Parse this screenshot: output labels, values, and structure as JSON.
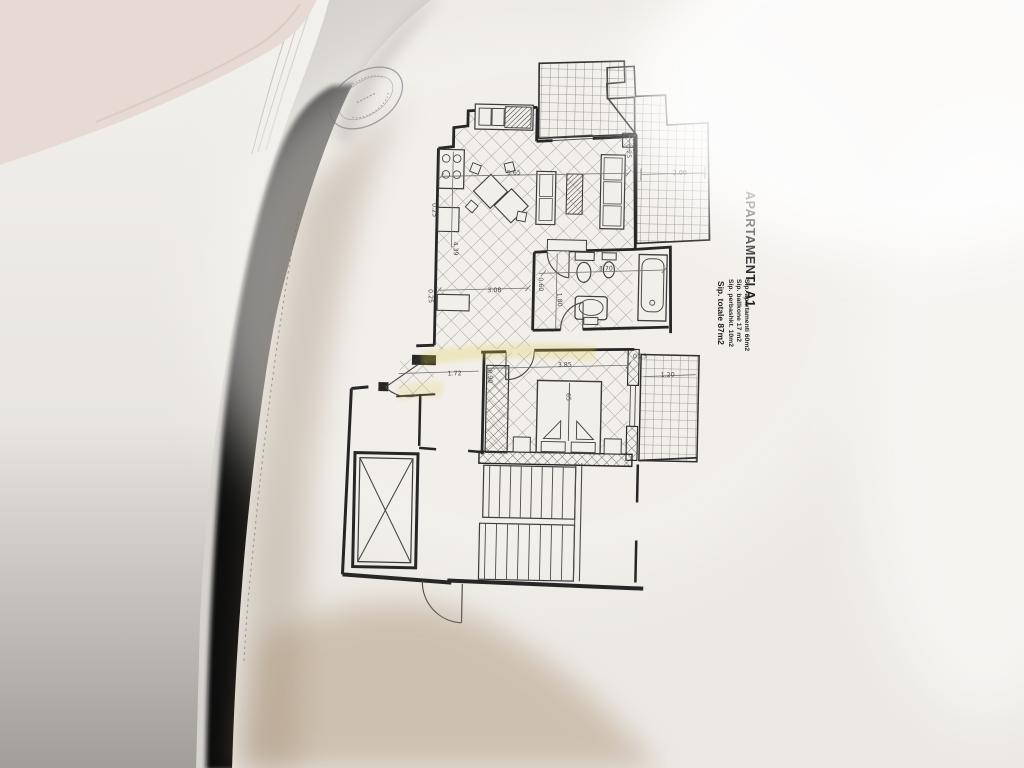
{
  "annotations": {
    "title": "APARTAMENTI A1",
    "specs": [
      "Sip. apartamenti 60m2",
      "Sip. ballkone 17 m2",
      "Sip. perbashkt. 10m2",
      "Sip. totale 87m2"
    ]
  },
  "plan": {
    "dimensions": [
      {
        "text": "5.65",
        "x": 503,
        "y": 175,
        "rot": -2
      },
      {
        "text": "4.39",
        "x": 451,
        "y": 243,
        "rot": 87
      },
      {
        "text": "0.25",
        "x": 429,
        "y": 205,
        "rot": 87
      },
      {
        "text": "3.08",
        "x": 486,
        "y": 293,
        "rot": -2
      },
      {
        "text": "0.25",
        "x": 427,
        "y": 291,
        "rot": 87
      },
      {
        "text": "0.60",
        "x": 537,
        "y": 277,
        "rot": 87
      },
      {
        "text": "3.70",
        "x": 597,
        "y": 269,
        "rot": -2
      },
      {
        "text": "1.80",
        "x": 556,
        "y": 292,
        "rot": 87
      },
      {
        "text": "0.25",
        "x": 622,
        "y": 142,
        "rot": 87
      },
      {
        "text": "2.00",
        "x": 669,
        "y": 172,
        "rot": -3
      },
      {
        "text": "1.72",
        "x": 448,
        "y": 377,
        "rot": -2
      },
      {
        "text": "0.25",
        "x": 414,
        "y": 367,
        "rot": -2
      },
      {
        "text": "0.90",
        "x": 488,
        "y": 370,
        "rot": 87
      },
      {
        "text": "3.85",
        "x": 558,
        "y": 366,
        "rot": -2
      },
      {
        "text": "65",
        "x": 567,
        "y": 392,
        "rot": 87
      },
      {
        "text": "0.25",
        "x": 633,
        "y": 356,
        "rot": -2
      },
      {
        "text": "1.20",
        "x": 661,
        "y": 374,
        "rot": -2
      },
      {
        "text": "0.25",
        "x": 628,
        "y": 136,
        "rot": 87
      }
    ]
  },
  "colors": {
    "paper": "#ece9e4",
    "ink": "#262626",
    "highlighter": "#e3cd4e",
    "shadow": "#a5896a",
    "black_gap": "#0b0b0d",
    "pink_sheet": "#e7dad4"
  }
}
